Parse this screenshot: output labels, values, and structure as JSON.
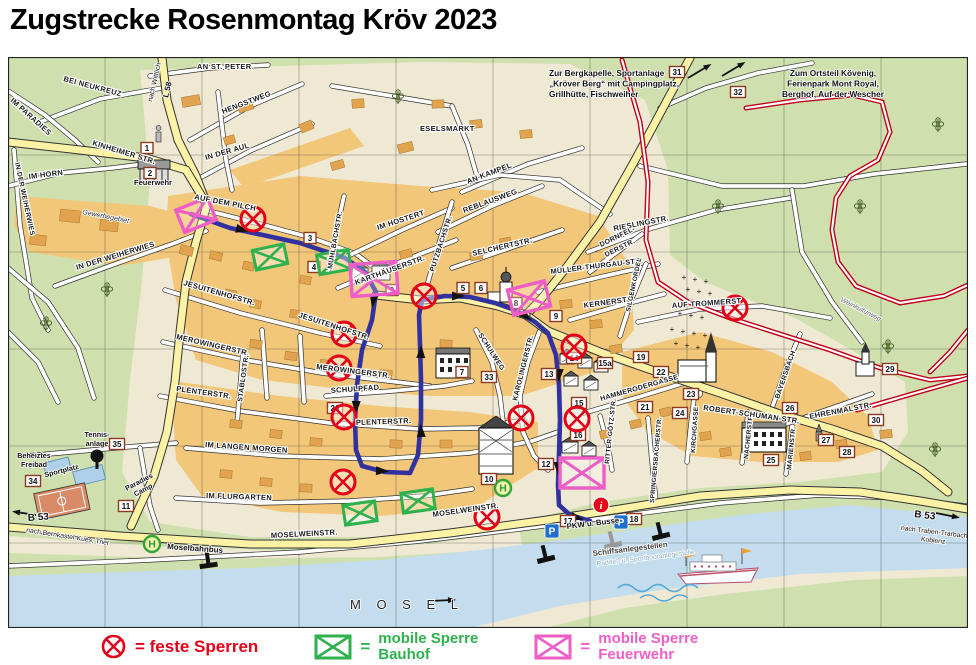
{
  "title": "Zugstrecke Rosenmontag Kröv 2023",
  "legend": {
    "feste_sperren_label": "= feste Sperren",
    "equals": "=",
    "bauhof_line1": "mobile Sperre",
    "bauhof_line2": "Bauhof",
    "feuerwehr_line1": "mobile Sperre",
    "feuerwehr_line2": "Feuerwehr"
  },
  "colors": {
    "route": "#31319f",
    "feste_sperre": "#e30018",
    "bauhof": "#2fb14e",
    "feuerwehr": "#ee5ec6",
    "road_major": "#fbf2a5",
    "water": "#c3ddee",
    "field": "#cfe0ae",
    "town": "#f2c779",
    "town_light": "#efe9d4",
    "building": "#e2a34f",
    "weinkulturweg": "#c00018"
  },
  "icons": {
    "feste_sperre_icon": "red-circle-x",
    "bauhof_icon": "green-crossed-box",
    "feuerwehr_icon": "magenta-crossed-box",
    "parkplatz_icon": "blue-p-square",
    "haltestelle_icon": "green-h-circle",
    "info_icon": "red-i-circle"
  },
  "street_labels": [
    "AN ST. PETER",
    "BEI NEUKREUZ",
    "HENGSTWEG",
    "IM PARADIES",
    "KINHEIMER STR.",
    "IN DER AUL",
    "IM HORN",
    "IN DER WEIHERWIES",
    "AUF DEM PILCH",
    "IN DER WEIHERWIES",
    "ESELSMARKT",
    "AN KAMPEL",
    "IM HOSTERT",
    "KARTHÄUSERSTR.",
    "PUTZBACHSTR.",
    "MÜHLBACHSTR.",
    "REBLAUSWEG",
    "SELCHERTSTR.",
    "RIESLINGSTR.",
    "DORNFEL-",
    "DERSTR.",
    "MÜLLER-THURGAU-STR.",
    "KERNERSTR.",
    "SILGENKORDEL",
    "AUF TROMMERST",
    "JESUITENHOFSTR.",
    "JESUITENHOFSTR.",
    "MEROWINGERSTR.",
    "MEROWINGERSTR.",
    "SCHULWEG",
    "SCHULPFAD",
    "KAROLINGERSTR.",
    "PLENTERSTR.",
    "PLENTERSTR.",
    "STABLOSTR.",
    "IM LANGEN MORGEN",
    "IM FLURGARTEN",
    "MOSELWEINSTR.",
    "MOSELWEINSTR.",
    "HAMMERODERGASSE",
    "RITTER-GÖTZ-STR.",
    "SPRINGIERSBACHERSTR.",
    "KIRCHGASSE",
    "NACHERSTR.",
    "MARIENSTR.",
    "ROBERT-SCHUMAN-STR.",
    "EHRENMALSTR.",
    "BAYERSBACH"
  ],
  "annotations": [
    {
      "lines": [
        "Zur Bergkapelle, Sportanlage",
        "„Kröver Berg“ mit Campingplatz,",
        "Grillhütte, Fischweiher"
      ]
    },
    {
      "lines": [
        "Zum Ortsteil Kövenig,",
        "Ferienpark Mont Royal,",
        "Berghof, Auf der Wescher"
      ]
    },
    {
      "lines": [
        "nach Wittlich"
      ]
    },
    {
      "lines": [
        "L 58"
      ]
    },
    {
      "lines": [
        "Feuerwehr"
      ]
    },
    {
      "lines": [
        "Gewerbegebiet"
      ]
    },
    {
      "lines": [
        "Tennis-",
        "anlage"
      ]
    },
    {
      "lines": [
        "Beheiztes",
        "Freibad"
      ]
    },
    {
      "lines": [
        "Sportplatz"
      ]
    },
    {
      "lines": [
        "Paradies",
        "Camp"
      ]
    },
    {
      "lines": [
        "Moselbahnbus"
      ]
    },
    {
      "lines": [
        "nach Bernkastel-Kues, Trier"
      ]
    },
    {
      "lines": [
        "B 53"
      ]
    },
    {
      "lines": [
        "B 53"
      ]
    },
    {
      "lines": [
        "nach Traben-Trarbach",
        "Koblenz"
      ]
    },
    {
      "lines": [
        "PKW u. Busse"
      ]
    },
    {
      "lines": [
        "Schiffsanlegestellen"
      ]
    },
    {
      "lines": [
        "Paddel- u. Sportbootanlegestelle"
      ]
    },
    {
      "lines": [
        "Weinkulturweg"
      ]
    },
    {
      "lines": [
        "M O S E L"
      ]
    }
  ],
  "markers": [
    "1",
    "2",
    "3",
    "4",
    "5",
    "6",
    "7",
    "8",
    "9",
    "9",
    "10",
    "11",
    "12",
    "13",
    "14",
    "15",
    "15a",
    "16",
    "17",
    "18",
    "19",
    "20",
    "21",
    "22",
    "23",
    "24",
    "25",
    "26",
    "27",
    "28",
    "29",
    "30",
    "31",
    "32",
    "33",
    "34",
    "35"
  ]
}
